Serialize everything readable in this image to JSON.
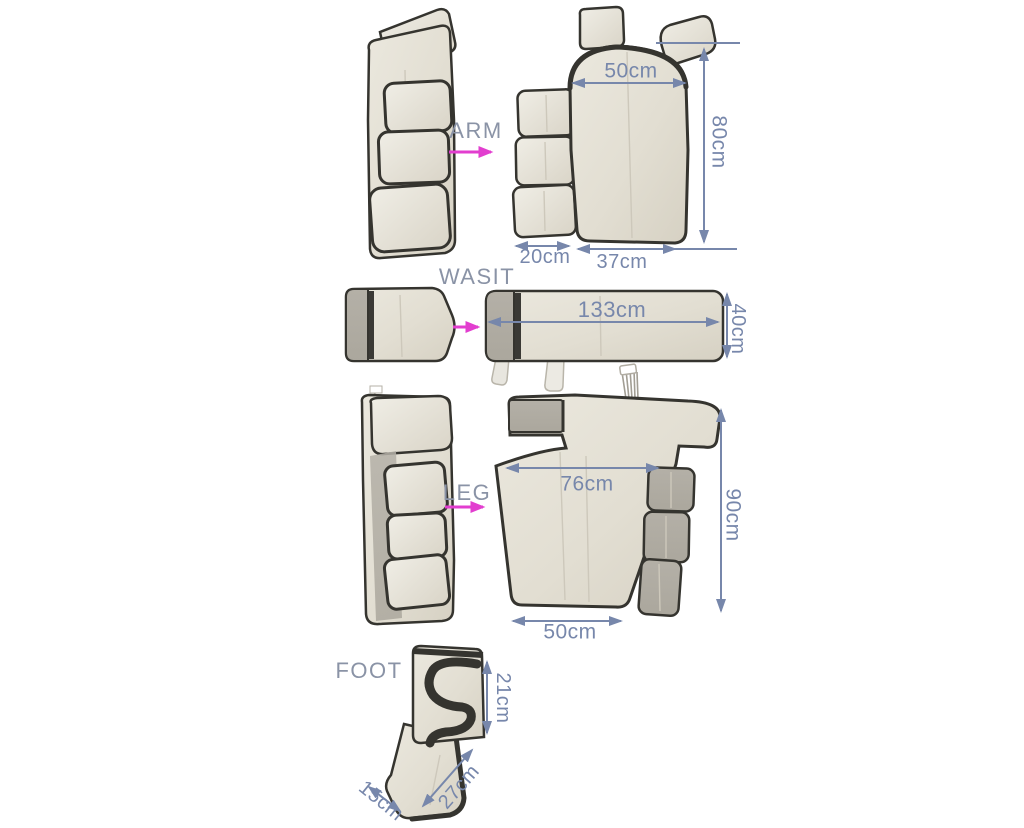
{
  "colors": {
    "dim_blue": "#7787ab",
    "label_gray": "#8a93a6",
    "arrow_pink": "#e23ecf",
    "fabric_light": "#ebe8de",
    "fabric_dark": "#d6d1c3",
    "velcro_gray": "#aba79d",
    "trim_dark": "#35342f"
  },
  "icons": {
    "unfold_arrow": "pink right arrow from folded garment to unfolded garment",
    "dimension_arrow": "blue double-headed measurement arrow"
  },
  "sections": {
    "arm": {
      "label": "ARM",
      "dims": {
        "top_width": "50cm",
        "height": "80cm",
        "flap_width": "20cm",
        "body_width": "37cm"
      }
    },
    "waist": {
      "label": "WASIT",
      "dims": {
        "length": "133cm",
        "height": "40cm"
      }
    },
    "leg": {
      "label": "LEG",
      "dims": {
        "upper_width": "76cm",
        "height": "90cm",
        "bottom_width": "50cm"
      }
    },
    "foot": {
      "label": "FOOT",
      "dims": {
        "height": "21cm",
        "length": "27cm",
        "width": "15cm"
      }
    }
  }
}
